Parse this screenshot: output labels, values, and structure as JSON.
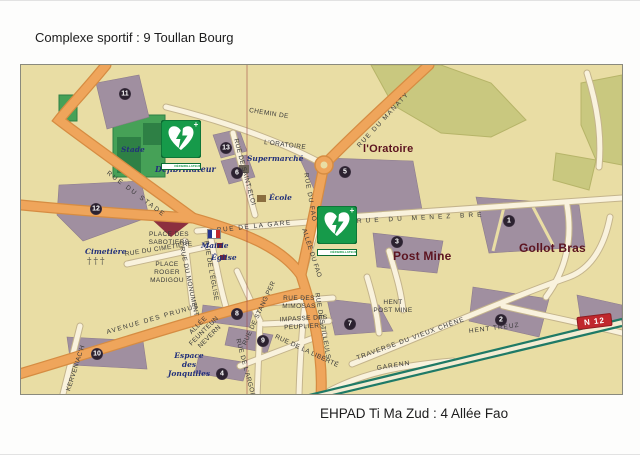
{
  "page": {
    "title": "Complexe sportif : 9 Toullan Bourg",
    "caption": "EHPAD Ti Ma Zud : 4 Allée Fao"
  },
  "map": {
    "colors": {
      "background": "#e9dda4",
      "main_road": "#efa55b",
      "minor_road": "#f9f2dd",
      "building": "#a08fa0",
      "woods": "#c9c87f",
      "stadium_green": "#46a157",
      "marker_green": "#169a4a",
      "place_label": "#5c1420",
      "poi_label": "#22307a",
      "n12_red": "#c0272d"
    },
    "streets": [
      {
        "label": "CHEMIN DE"
      },
      {
        "label": "L'ORATOIRE"
      },
      {
        "label": "RUE DU MANATY"
      },
      {
        "label": "RUE DE SAINT-ELOI"
      },
      {
        "label": "RUE DU STADE"
      },
      {
        "label": "RUE DU FAO"
      },
      {
        "label": "RUE DE LA GARE"
      },
      {
        "label": "RUE DU MENEZ BRE"
      },
      {
        "label": "ALLÉE DU FAO"
      },
      {
        "label": "RUE DU CIMETIÈRE"
      },
      {
        "label": "RUE DU MONUMENT"
      },
      {
        "label": "RUE DE L'ÉGLISE"
      },
      {
        "label": "PLACE DES\nSABOTIERS"
      },
      {
        "label": "PLACE\nROGER\nMADIGOU"
      },
      {
        "label": "RUE DES\nMIMOSAS"
      },
      {
        "label": "IMPASSE DES\nPEUPLIERS"
      },
      {
        "label": "RUE DE LA LIBERTÉ"
      },
      {
        "label": "RUE DES TILLEULS"
      },
      {
        "label": "RUE DE L'ARGOAT"
      },
      {
        "label": "RUE DE STANG PER"
      },
      {
        "label": "AVENUE DES PRUNUS"
      },
      {
        "label": "KERVENIAC'H"
      },
      {
        "label": "HENT\nPOST MINE"
      },
      {
        "label": "TRAVERSE DU VIEUX CHÊNE"
      },
      {
        "label": "HENT TREUZ"
      },
      {
        "label": "GARENN"
      },
      {
        "label": "ALLÉE\nFEUNTEUN\nNEVERN"
      }
    ],
    "places": [
      {
        "label": "l'Oratoire"
      },
      {
        "label": "Post Mine"
      },
      {
        "label": "Gollot Bras"
      }
    ],
    "pois": [
      {
        "label": "Stade"
      },
      {
        "label": "Cimetière"
      },
      {
        "label": "Mairie"
      },
      {
        "label": "Église"
      },
      {
        "label": "Supermarché"
      },
      {
        "label": "École"
      },
      {
        "label": "Défibrillateur"
      },
      {
        "label": "Espace\ndes Jonquilles"
      }
    ],
    "markers": [
      {
        "name": "defibrillateur-complexe-sportif",
        "band": "DÉFIBRILLATEUR"
      },
      {
        "name": "defibrillateur-ehpad",
        "band": "DÉFIBRILLATEUR"
      }
    ],
    "road_sign": {
      "label": "N 12"
    },
    "points": [
      {
        "n": "11"
      },
      {
        "n": "13"
      },
      {
        "n": "6"
      },
      {
        "n": "12"
      },
      {
        "n": "5"
      },
      {
        "n": "3"
      },
      {
        "n": "1"
      },
      {
        "n": "7"
      },
      {
        "n": "2"
      },
      {
        "n": "10"
      },
      {
        "n": "8"
      },
      {
        "n": "9"
      },
      {
        "n": "4"
      }
    ]
  }
}
